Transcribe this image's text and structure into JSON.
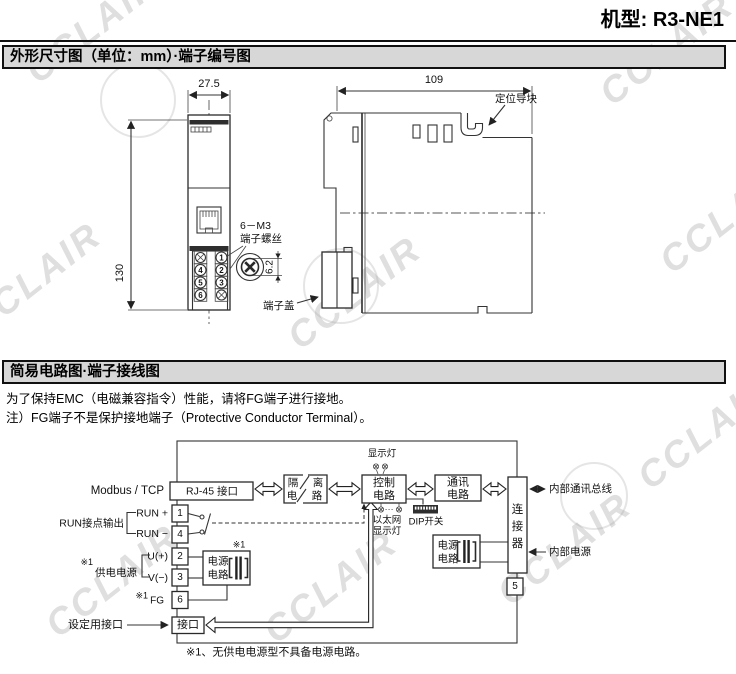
{
  "page": {
    "model_label": "机型: R3-NE1",
    "watermark": "CCLAIR",
    "footer_note": "※1、无供电电源型不具备电源电路。"
  },
  "section1": {
    "title": "外形尺寸图（单位：mm）·端子编号图",
    "dims": {
      "width": "27.5",
      "height": "130",
      "depth": "109",
      "screw": "6.2"
    },
    "labels": {
      "screw_line1": "6－M3",
      "screw_line2": "端子螺丝",
      "terminal_cover": "端子盖",
      "guide_block": "定位导块"
    },
    "front_terminals": {
      "t1": "1",
      "t2": "2",
      "t3": "3",
      "t4": "4",
      "t5": "5",
      "t6": "6"
    }
  },
  "section2": {
    "title": "简易电路图·端子接线图",
    "note1": "为了保持EMC（电磁兼容指令）性能，请将FG端子进行接地。",
    "note2": "注）FG端子不是保护接地端子（Protective Conductor Terminal）。",
    "circuit": {
      "modbus": "Modbus / TCP",
      "rj45": "RJ-45 接口",
      "iso_l1": "隔",
      "iso_l2": "电",
      "iso_r1": "离",
      "iso_r2": "路",
      "control_l1": "控制",
      "control_l2": "电路",
      "comm_l1": "通讯",
      "comm_l2": "电路",
      "connector": "连接器",
      "bus_label": "内部通讯总线",
      "indicator_label": "显示灯",
      "eth_l1": "以太网",
      "eth_l2": "显示灯",
      "dip_label": "DIP开关",
      "run_plus": "RUN +",
      "run_minus": "RUN −",
      "run_out": "RUN接点输出",
      "u_plus": "U(+)",
      "v_minus": "V(−)",
      "supply_ref": "※1",
      "supply_label": "供电电源",
      "fg_ref": "※1",
      "fg_label": "FG",
      "power_l1": "电源",
      "power_l2": "电路",
      "power_ref": "※1",
      "setting_label": "设定用接口",
      "port_label": "接口",
      "internal_power": "内部电源",
      "terminals": {
        "t1": "1",
        "t2": "2",
        "t3": "3",
        "t4": "4",
        "t5": "5",
        "t6": "6"
      }
    }
  }
}
